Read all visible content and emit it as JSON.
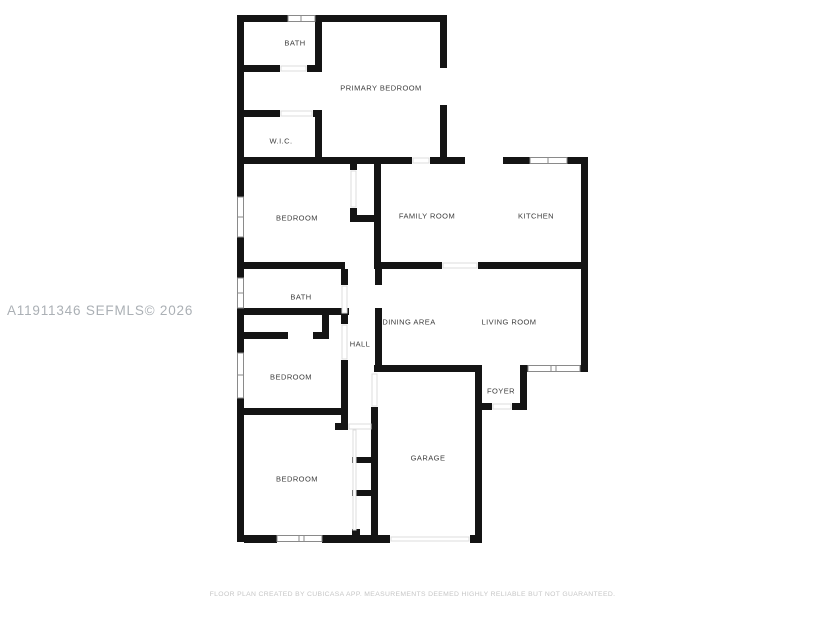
{
  "watermark": "A11911346  SEFMLS© 2026",
  "footer": "FLOOR PLAN CREATED BY CUBICASA APP. MEASUREMENTS DEEMED HIGHLY RELIABLE BUT NOT GUARANTEED.",
  "rooms": [
    {
      "label": "BATH"
    },
    {
      "label": "PRIMARY BEDROOM"
    },
    {
      "label": "W.I.C."
    },
    {
      "label": "BEDROOM"
    },
    {
      "label": "FAMILY ROOM"
    },
    {
      "label": "KITCHEN"
    },
    {
      "label": "BATH"
    },
    {
      "label": "DINING AREA"
    },
    {
      "label": "LIVING ROOM"
    },
    {
      "label": "HALL"
    },
    {
      "label": "BEDROOM"
    },
    {
      "label": "FOYER"
    },
    {
      "label": "BEDROOM"
    },
    {
      "label": "GARAGE"
    }
  ],
  "colors": {
    "wall": "#141414",
    "room_label": "#3c3c3c",
    "watermark": "#abb0b5",
    "footer": "#c6c6c6",
    "background": "#ffffff"
  }
}
